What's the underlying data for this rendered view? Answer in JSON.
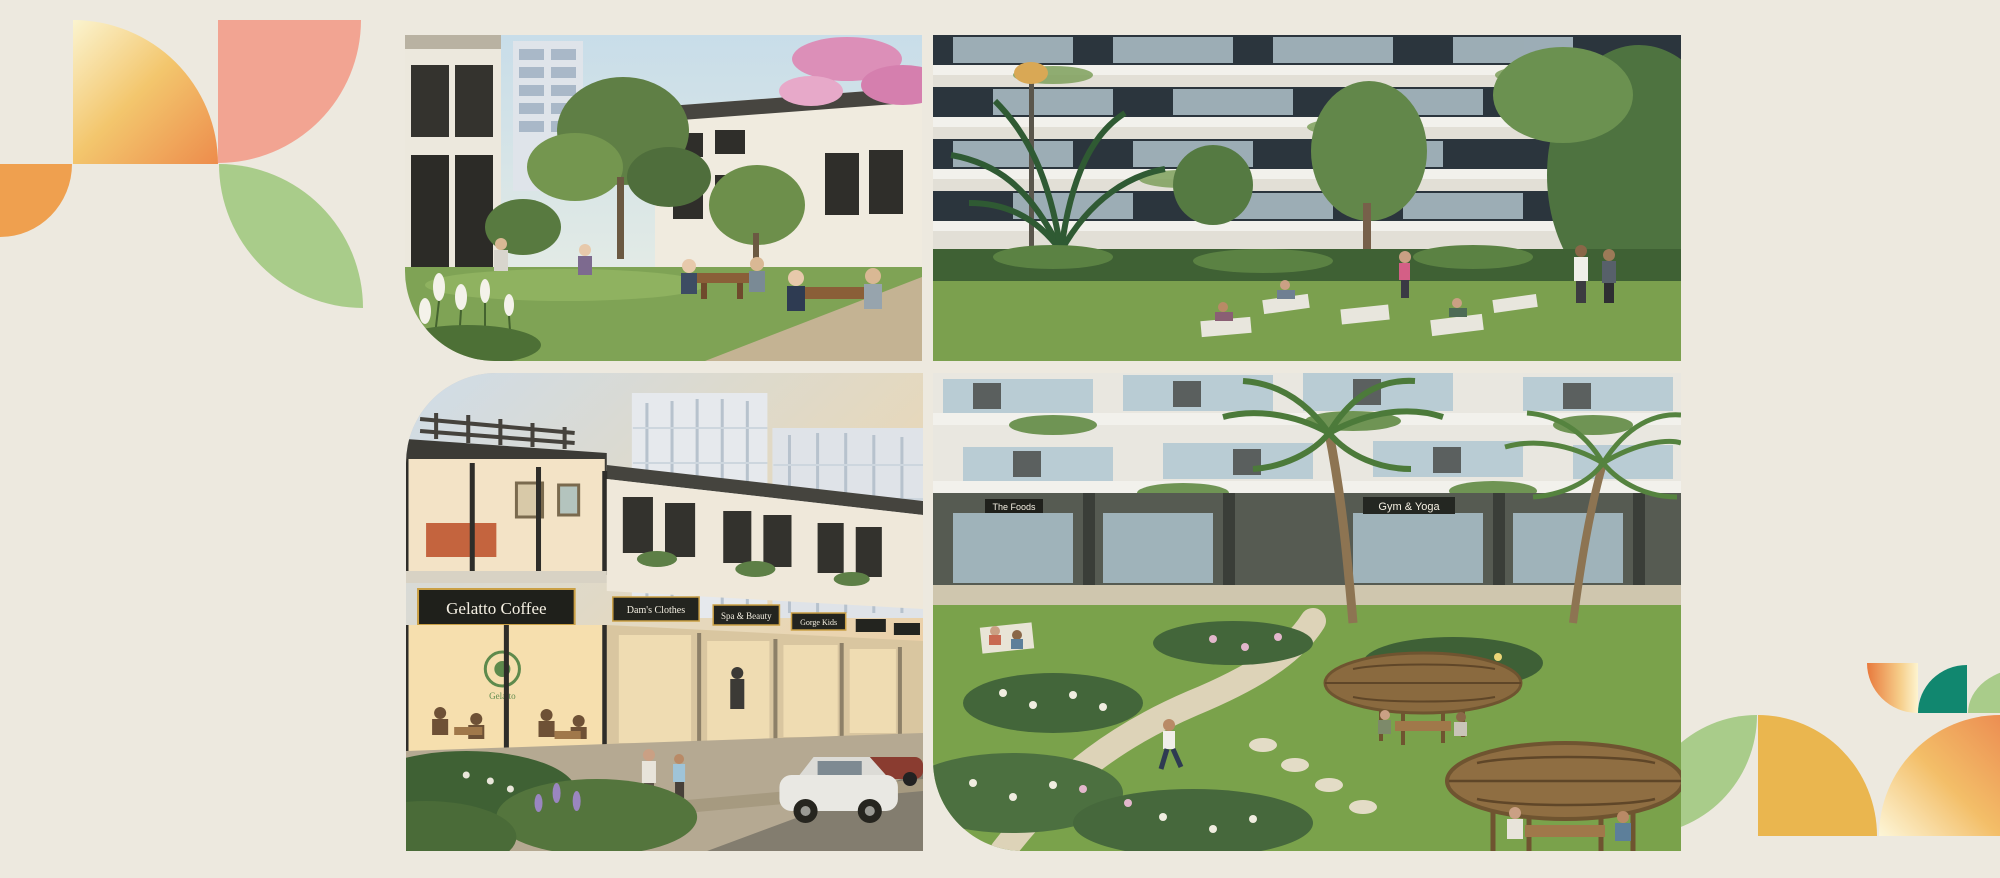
{
  "canvas": {
    "background": "#EDE9DF",
    "width": 2000,
    "height": 878
  },
  "decor": {
    "top_left_cluster": {
      "gradient_from": "#FBF4CF",
      "gradient_to": "#ED8C4C",
      "pink": "#F2A492",
      "orange": "#EFA04F",
      "green": "#A9CC8A"
    },
    "bottom_right_cluster": {
      "green": "#A9CC8A",
      "gold": "#EAB64F",
      "teal": "#11876F",
      "gradient_from": "#FDF6D8",
      "gradient_to": "#EC8E52"
    }
  },
  "gallery": {
    "photos": [
      {
        "name": "courtyard-dining",
        "alt": "Residents dining and working at wooden tables in a lush landscaped courtyard between residential blocks with pink blossoms"
      },
      {
        "name": "yoga-garden",
        "alt": "People practising yoga on mats in a green courtyard garden below apartment balconies, palms and a garden lamp"
      },
      {
        "name": "shophouse-street",
        "alt": "Evening view of two-storey shophouses with lit storefronts, upper-floor living rooms and a white car parked on the street",
        "signs": [
          "Gelatto Coffee",
          "Dam's Clothes",
          "Spa & Beauty",
          "Gorge Kids"
        ],
        "cafe_logo": "Gelatto"
      },
      {
        "name": "garden-pavilions",
        "alt": "Aerial view of a winding garden path with round timber dining pavilions, palm trees and ground-floor shops",
        "signs": [
          "The Foods",
          "Gym & Yoga"
        ]
      }
    ]
  }
}
